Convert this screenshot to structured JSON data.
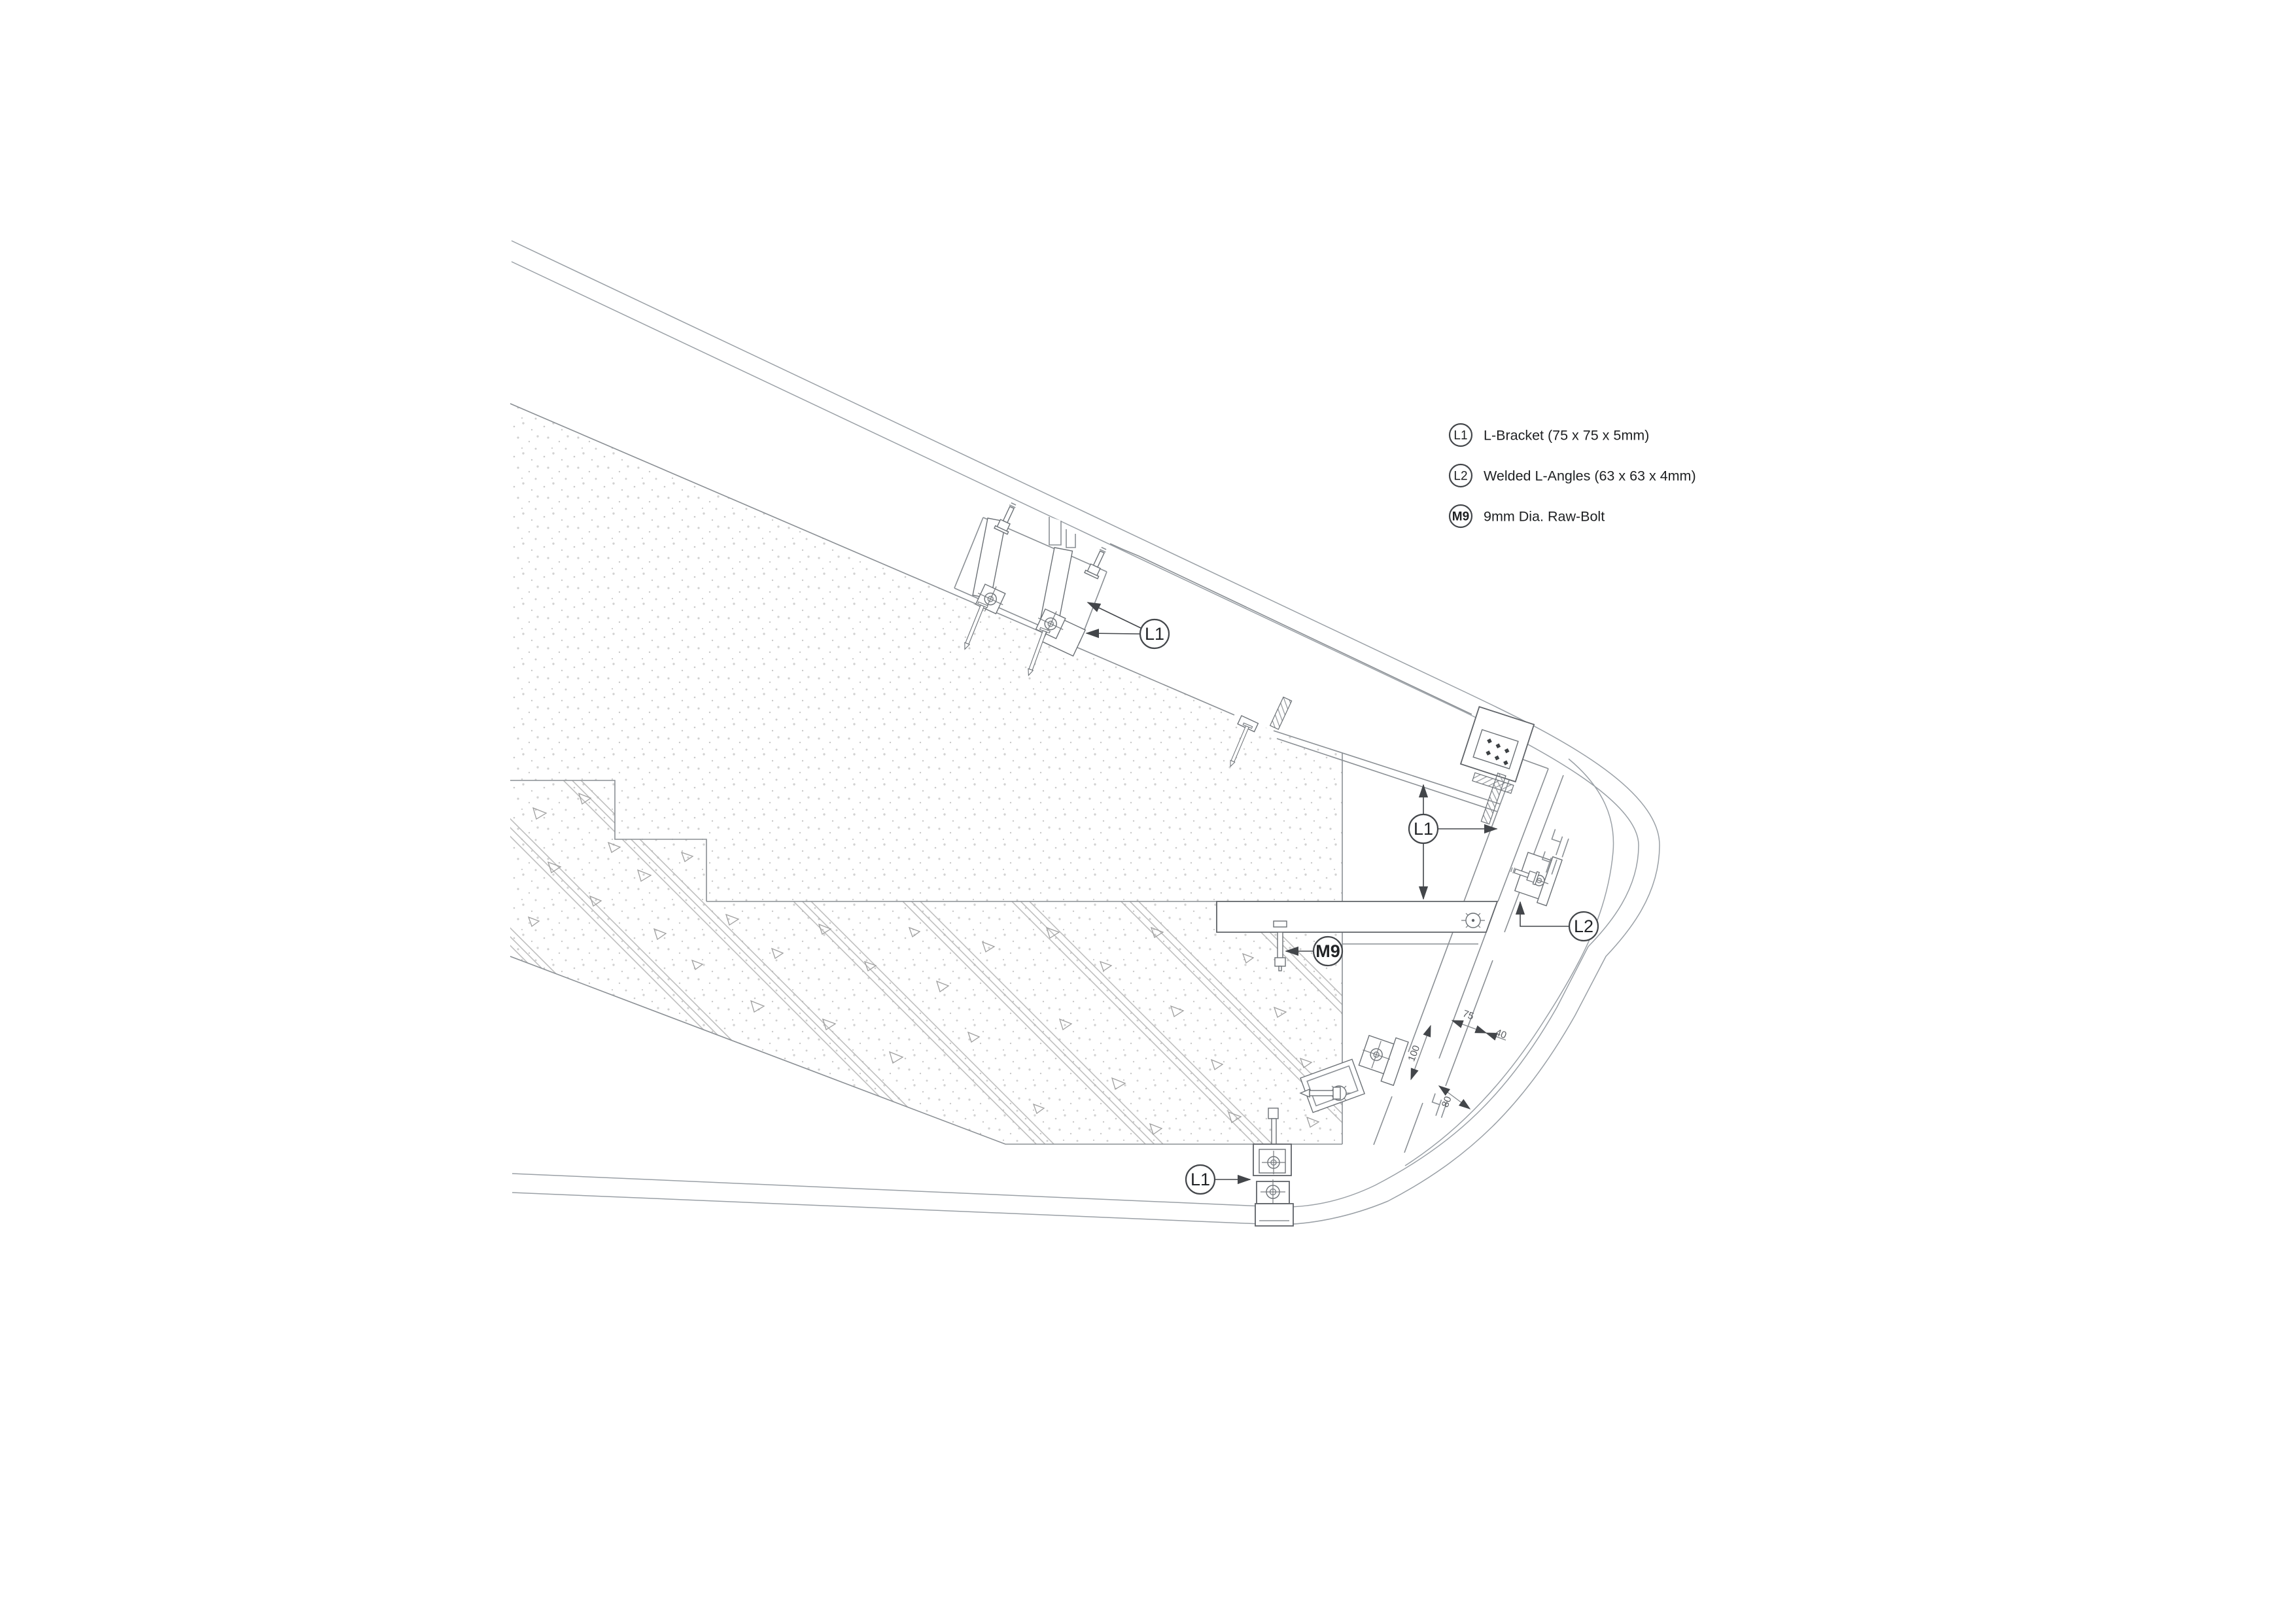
{
  "page": {
    "type": "construction-detail-drawing",
    "background": "#ffffff"
  },
  "colors": {
    "line": "#5f6368",
    "callout": "#43464a",
    "hatch": "#b5b5b5",
    "stipple": "#c9c9c9",
    "text": "#1d1f21"
  },
  "legend": {
    "items": [
      {
        "tag": "L1",
        "label": "L-Bracket (75 x 75 x 5mm)"
      },
      {
        "tag": "L2",
        "label": "Welded L-Angles (63 x 63 x 4mm)"
      },
      {
        "tag": "M9",
        "label": "9mm Dia. Raw-Bolt"
      }
    ]
  },
  "callouts": {
    "top_bracket_tag": "L1",
    "nose_bracket_tag": "L1",
    "bottom_bracket_tag": "L1",
    "welded_angle_tag": "L2",
    "raw_bolt_tag": "M9"
  },
  "dimensions": {
    "bracket_spacing": "100",
    "top_width": "75",
    "top_offset": "40",
    "bottom_width": "80"
  }
}
